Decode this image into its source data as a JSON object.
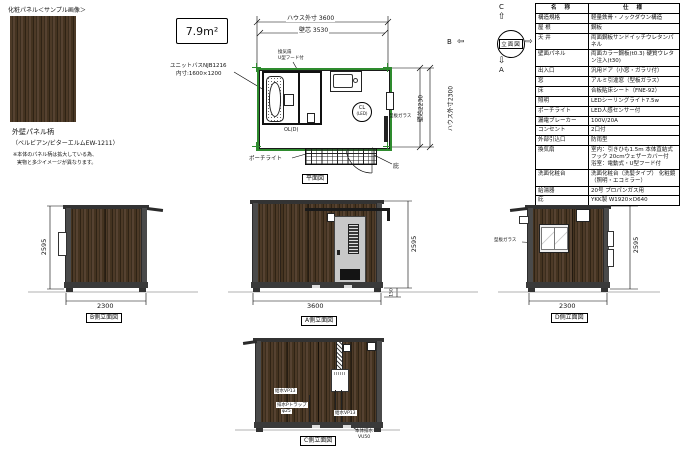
{
  "sample": {
    "title": "化粧パネル＜サンプル画像＞",
    "caption_line1": "外壁パネル柄",
    "caption_line2": "（ベルビアン/ビターエルムEW-1211）",
    "note_line1": "※本体のパネル柄は拡大している為、",
    "note_line2": "実物と多少イメージが異なります。"
  },
  "area_label": "7.9m²",
  "plan": {
    "dims": {
      "outer_w": "ハウス外寸 3600",
      "core_w": "壁芯 3530",
      "core_h": "壁芯2230",
      "outer_h": "ハウス外寸2300"
    },
    "unitbath_line1": "ユニットバスNJB1216",
    "unitbath_line2": "内寸:1600×1200",
    "vent_note_line1": "換気扇",
    "vent_note_line2": "U型フード付",
    "cl_label": "CL",
    "cl_sub": "(LED)",
    "ol_label": "OL(D)",
    "glass_label": "型板ガラス",
    "porchlight_label": "ポーチライト",
    "canopy_label": "庇",
    "caption": "平面図"
  },
  "compass": {
    "up": "C",
    "down": "A",
    "left": "B",
    "right": "D",
    "center": "立面図",
    "up_arrow": "⇧",
    "down_arrow": "⇩",
    "left_arrow": "⇦",
    "right_arrow": "⇨"
  },
  "spec_table": {
    "header": {
      "name": "名 称",
      "spec": "仕 様"
    },
    "rows": [
      {
        "name": "構造規格",
        "spec": "軽量鉄骨・ノックダウン構造"
      },
      {
        "name": "屋 根",
        "spec": "鋼板"
      },
      {
        "name": "天 井",
        "spec": "両面鋼板サンドイッチウレタンパネル"
      },
      {
        "name": "壁面パネル",
        "spec": "両面カラー鋼板(t0.3) 硬質ウレタン注入(t30)"
      },
      {
        "name": "出入口",
        "spec": "汎用ドア（小窓・ガラリ付）"
      },
      {
        "name": "窓",
        "spec": "アルミ引違窓（型板ガラス）"
      },
      {
        "name": "床",
        "spec": "合板貼床シート（FNE-92）"
      },
      {
        "name": "照明",
        "spec": "LEDシーリングライト7.5w"
      },
      {
        "name": "ポーチライト",
        "spec": "LED人感センサー付"
      },
      {
        "name": "漏電ブレーカー",
        "spec": "100V/20A"
      },
      {
        "name": "コンセント",
        "spec": "2口付"
      },
      {
        "name": "外部引込口",
        "spec": "防雨型"
      },
      {
        "name": "換気扇",
        "spec": "室内：引きひも1.5m 本体直結式フック 20cmウェザーカバー付　浴室：電動式・U型フード付"
      },
      {
        "name": "洗面化粧台",
        "spec": "洗面化粧台（洗髪タイプ） 化粧鏡（照明・エコミラー）"
      },
      {
        "name": "給湯器",
        "spec": "20号 プロパンガス用"
      },
      {
        "name": "庇",
        "spec": "YKK製 W1920×D640"
      }
    ]
  },
  "elevations": {
    "b": {
      "caption": "B側立面図",
      "width_dim": "2300",
      "height_dim": "2595"
    },
    "a": {
      "caption": "A側立面図",
      "width_dim": "3600",
      "height_dim": "2595",
      "floor_dim": "150"
    },
    "d": {
      "caption": "D側立面図",
      "width_dim": "2300",
      "height_dim": "2595",
      "glass_label": "型板ガラス"
    },
    "c": {
      "caption": "C側立面図",
      "supply_label": "給水VP13",
      "trap_label1": "排水Pトラップ",
      "trap_label2": "φ25",
      "supply2_label": "給水VP13",
      "drain_label1": "本体排水",
      "drain_label2": "VU50"
    }
  },
  "colors": {
    "plan_outline": "#2e8b2e",
    "wood": "#46351f",
    "frame": "#3f3f3f"
  }
}
